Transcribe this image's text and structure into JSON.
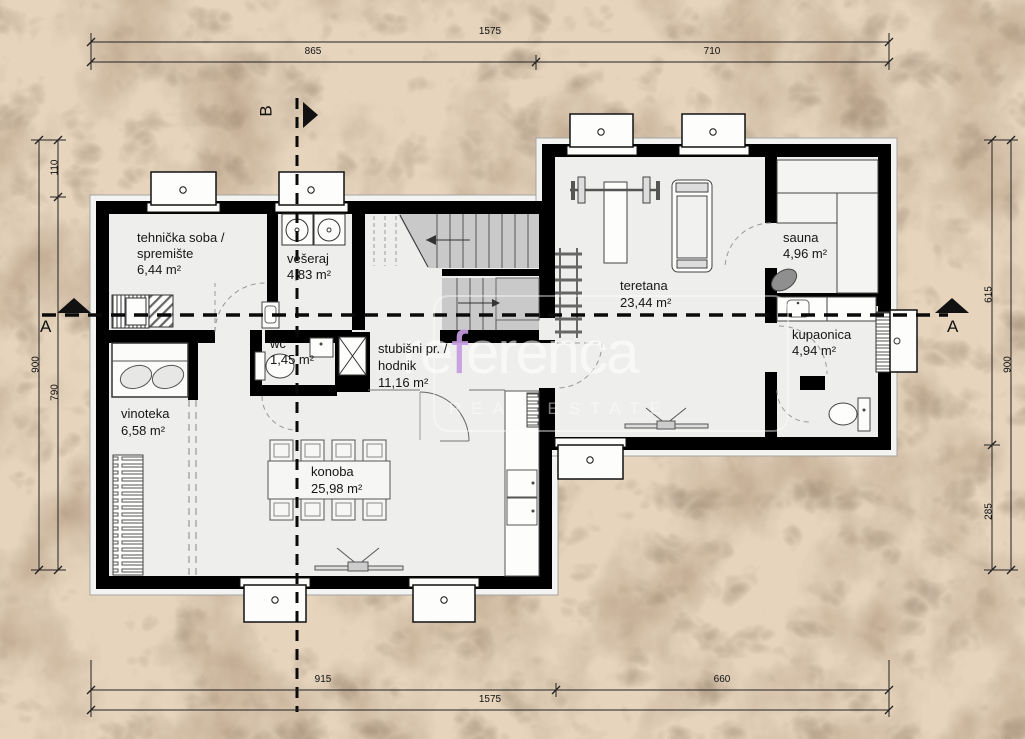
{
  "watermark": {
    "pre": "re",
    "accent": "f",
    "post": "erenca",
    "tagline": "REAL ESTATE"
  },
  "sections": {
    "a_left": "A",
    "a_right": "A",
    "b_top": "B"
  },
  "dims": {
    "top_total": "1575",
    "top_a": "865",
    "top_b": "710",
    "bottom_a": "915",
    "bottom_b": "660",
    "bottom_total": "1575",
    "left_outer": "900",
    "left_a": "110",
    "left_b": "790",
    "right_a": "615",
    "right_b": "285",
    "right_outer": "900"
  },
  "rooms": {
    "tehnicka": {
      "line1": "tehnička soba /",
      "line2": "spremište",
      "area": "6,44 m²"
    },
    "veseraj": {
      "line1": "vešeraj",
      "area": "4,83 m²"
    },
    "wc": {
      "line1": "wc",
      "area": "1,45 m²"
    },
    "stubisni": {
      "line1": "stubišni pr. /",
      "line2": "hodnik",
      "area": "11,16 m²"
    },
    "vinoteka": {
      "line1": "vinoteka",
      "area": "6,58 m²"
    },
    "konoba": {
      "line1": "konoba",
      "area": "25,98 m²"
    },
    "teretana": {
      "line1": "teretana",
      "area": "23,44 m²"
    },
    "sauna": {
      "line1": "sauna",
      "area": "4,96 m²"
    },
    "kupaonica": {
      "line1": "kupaonica",
      "area": "4,94 m²"
    }
  },
  "colors": {
    "wall": "#000000",
    "floor": "#eeeeec",
    "stair": "#c9c9c9",
    "accent": "#c59ce0",
    "ground": "#9c7f65"
  }
}
